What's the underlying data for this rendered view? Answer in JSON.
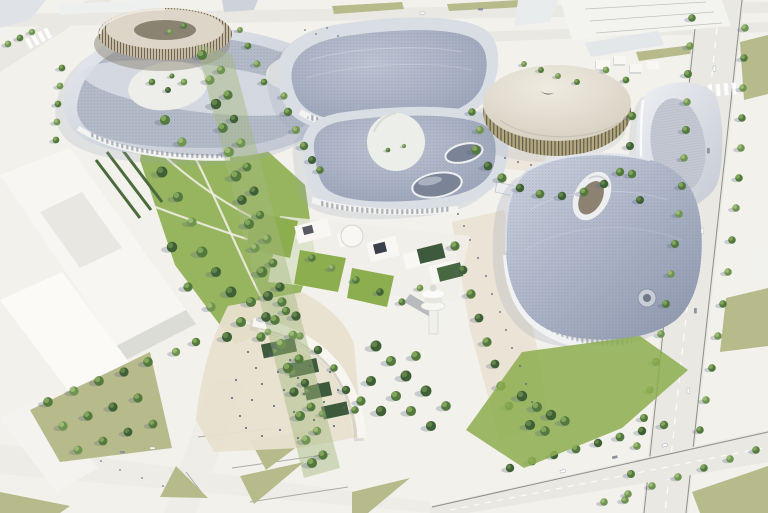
{
  "colors": {
    "ground": "#f3f1ec",
    "plaza": "#e8e0cf",
    "road": "#e9e8e3",
    "curb": "#8e8f88",
    "lawn": "#8cae4f",
    "lawnMuted": "#b7ba8b",
    "pool": "#3d5a3d",
    "hedge": "#4b6b3d",
    "pathLight": "#efece3",
    "rimLight": "#d9dde4",
    "roofGrid": "#9aa3b8",
    "roofDot": "#6f7890",
    "squircleLight": "#ccd2de",
    "squircleDark": "#8e98ae",
    "whiteBldg": "#f8f7f4",
    "grayRoof": "#ced3d9",
    "drumRoof": "#efebe0",
    "drumWall": "#b4a87f",
    "drumStripe": "#5f5b4c",
    "towerWall": "#c7bba4",
    "towerDeck": "#ddd6c8",
    "towerCourt": "#8a8372",
    "glass": "#7b8497",
    "glassTan": "#8d8271",
    "facade": "#f3f4f2",
    "shadow": "#9aa5b6",
    "people": "#5a6370",
    "arcWhite": "#f7f6f1",
    "treeLight": "#9cba74",
    "treeMid": "#54793f",
    "treeDark": "#3f5f37"
  },
  "scene": {
    "type": "architectural-aerial-rendering",
    "elements": [
      "ring-tower-pavilion",
      "north-exhibition-hall",
      "central-exhibition-hall",
      "round-arena",
      "east-hall",
      "main-squircle-arena",
      "observation-tower",
      "amphitheater-arc",
      "central-park",
      "tree-boulevard",
      "ring-road",
      "pedestrian-plaza"
    ]
  }
}
